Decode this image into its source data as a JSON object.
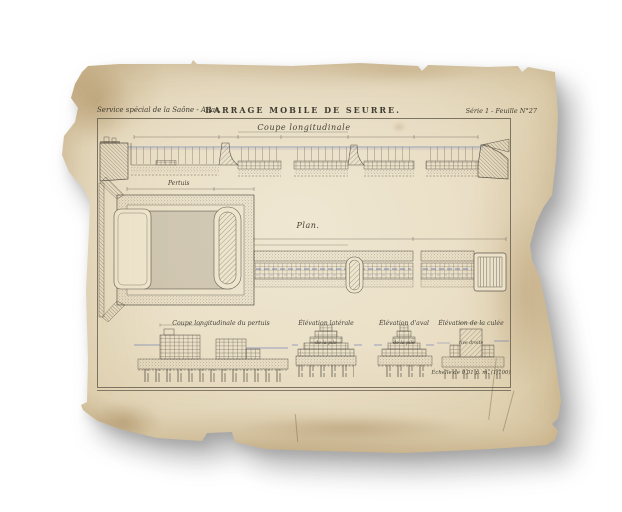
{
  "palette": {
    "background": "#ffffff",
    "paper": "#e9dfc6",
    "paper_edge": "#d5c099",
    "ink": "#5c574b",
    "water_blue": "#7d87b6"
  },
  "header": {
    "left": "Service spécial de la Saône - Atlas.",
    "center": "BARRAGE MOBILE DE SEURRE.",
    "right": "Série 1 - Feuille N°27"
  },
  "sections": {
    "coupe": {
      "title": "Coupe longitudinale",
      "label": "Pertuis"
    },
    "plan": {
      "title": "Plan."
    },
    "details": [
      {
        "title": "Coupe longitudinale du pertuis",
        "subtitle": ""
      },
      {
        "title": "Élévation latérale",
        "subtitle": "de la pile"
      },
      {
        "title": "Élévation d'aval",
        "subtitle": "de la pile"
      },
      {
        "title": "Élévation de la culée",
        "subtitle": "rive droite"
      }
    ],
    "scale_note": "Échelle de 0,01 p. m. (1/100)"
  }
}
